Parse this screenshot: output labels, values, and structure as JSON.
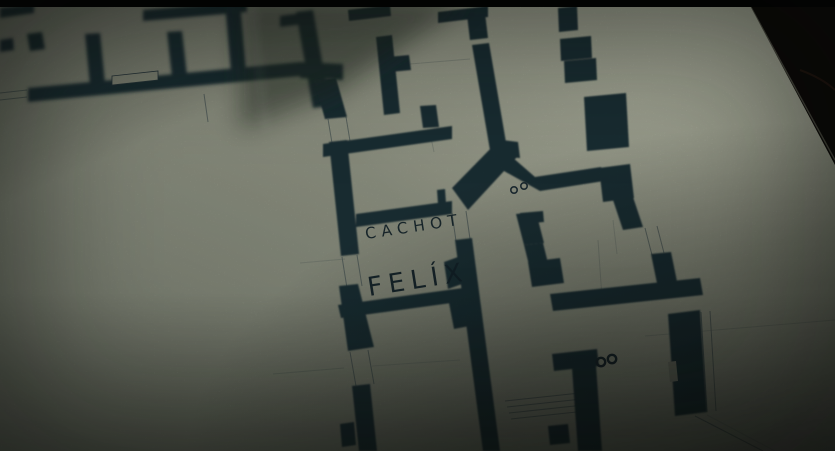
{
  "plan": {
    "labels": {
      "cachot": "CACHOT",
      "felix": "FELÍX"
    },
    "marks": {
      "upper_circles": "°°",
      "lower_circles": "°°"
    }
  },
  "colors": {
    "paper": "#989c8b",
    "ink": "#1f3038",
    "ink_text": "#15252d",
    "background_dark": "#0c0a07",
    "letterbox": "#000000"
  }
}
